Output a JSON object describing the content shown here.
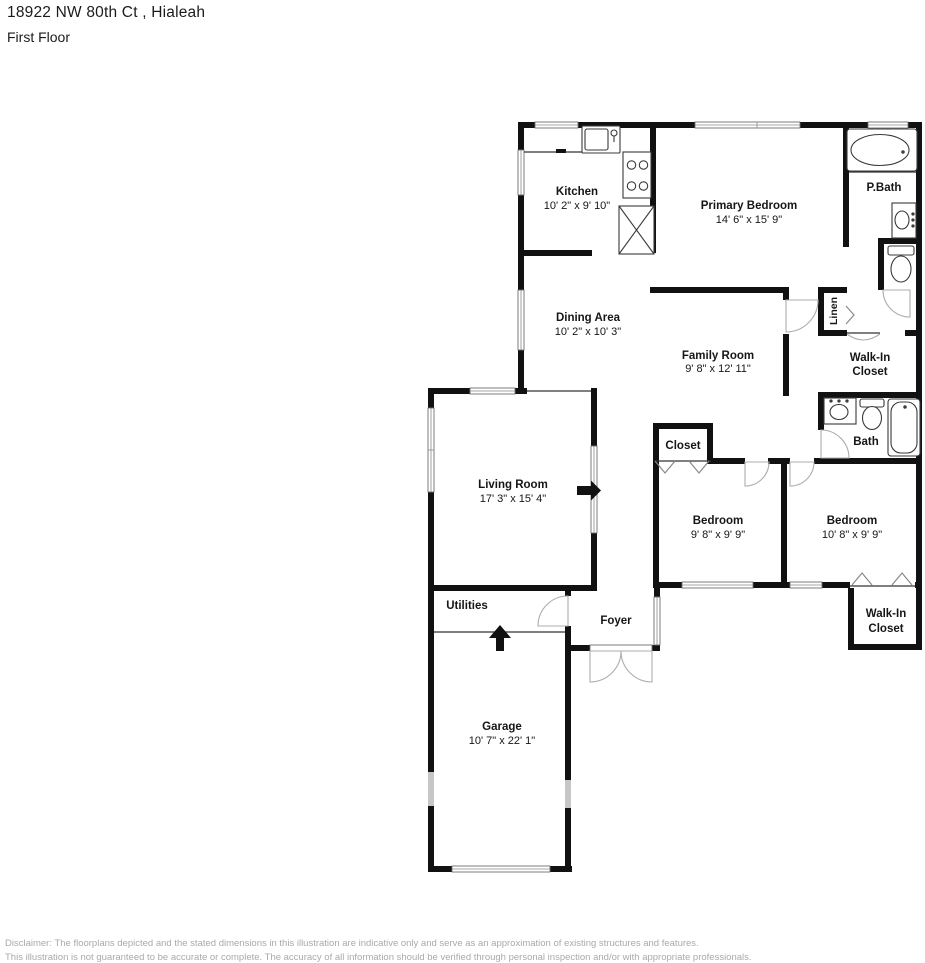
{
  "header": {
    "address": "18922 NW 80th Ct , Hialeah",
    "floor": "First Floor"
  },
  "floor_plan": {
    "rooms": {
      "kitchen": {
        "name": "Kitchen",
        "dims": "10' 2\" x 9' 10\""
      },
      "primary_bedroom": {
        "name": "Primary Bedroom",
        "dims": "14' 6\" x 15' 9\""
      },
      "p_bath": {
        "name": "P.Bath"
      },
      "dining_area": {
        "name": "Dining Area",
        "dims": "10' 2\" x 10' 3\""
      },
      "family_room": {
        "name": "Family Room",
        "dims": "9' 8\" x 12' 11\""
      },
      "linen": {
        "name": "Linen"
      },
      "walk_in_closet_upper": {
        "line1": "Walk-In",
        "line2": "Closet"
      },
      "bath": {
        "name": "Bath"
      },
      "closet": {
        "name": "Closet"
      },
      "bedroom_1": {
        "name": "Bedroom",
        "dims": "9' 8\" x 9' 9\""
      },
      "bedroom_2": {
        "name": "Bedroom",
        "dims": "10' 8\" x 9' 9\""
      },
      "living_room": {
        "name": "Living Room",
        "dims": "17' 3\" x 15' 4\""
      },
      "utilities": {
        "name": "Utilities"
      },
      "foyer": {
        "name": "Foyer"
      },
      "walk_in_closet_lower": {
        "line1": "Walk-In",
        "line2": "Closet"
      },
      "garage": {
        "name": "Garage",
        "dims": "10' 7\" x 22' 1\""
      }
    },
    "icons": {
      "kitchen_sink": "sink-icon",
      "stove": "stove-icon",
      "pantry": "pantry-icon",
      "bathtub": "bathtub-icon",
      "toilet": "toilet-icon",
      "entry_arrow": "entry-arrow-icon",
      "step_arrow": "step-arrow-icon"
    },
    "colors": {
      "wall": "#111111",
      "door_arc": "#adadad",
      "window_line": "#6e6e6e",
      "gap_gray": "#c6c6c6"
    }
  },
  "disclaimer": {
    "line1": "Disclaimer: The floorplans depicted and the stated dimensions in this illustration are indicative only and serve as an approximation of existing structures and features.",
    "line2": "This illustration is not guaranteed to be accurate or complete. The accuracy of all information should be verified through personal inspection and/or with appropriate professionals."
  }
}
